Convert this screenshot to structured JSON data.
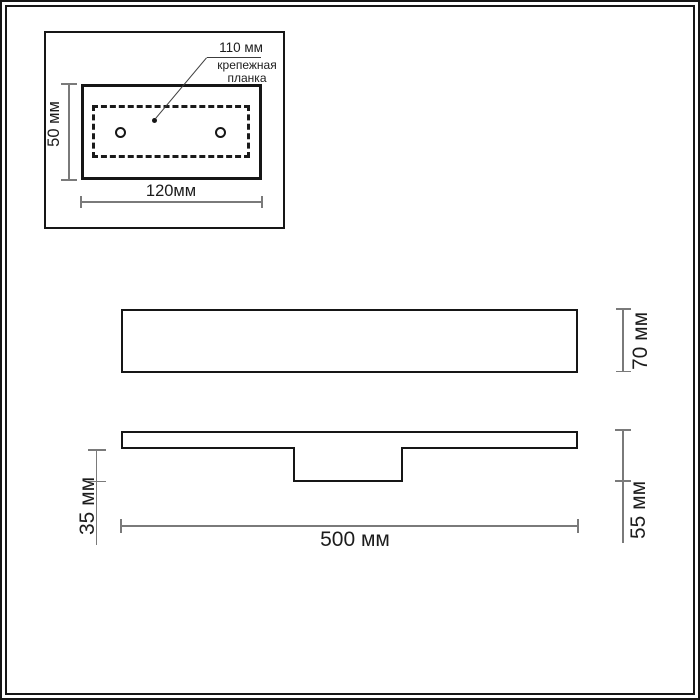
{
  "page": {
    "background": "#ffffff",
    "frame_color": "#161616"
  },
  "colors": {
    "outline": "#161616",
    "dimension_line": "#7a7a7a",
    "leader_line": "#3c3c3c",
    "text": "#1c1c1c"
  },
  "detail_inset": {
    "bracket_width_label": "110 мм",
    "bracket_name_label": "крепежная\nпланка",
    "plate_height_label": "50 мм",
    "plate_width_label": "120мм"
  },
  "front_view": {
    "height_label": "70 мм"
  },
  "side_view": {
    "box_depth_label": "35 мм",
    "fixture_width_label": "500 мм",
    "total_depth_label": "55 мм"
  }
}
